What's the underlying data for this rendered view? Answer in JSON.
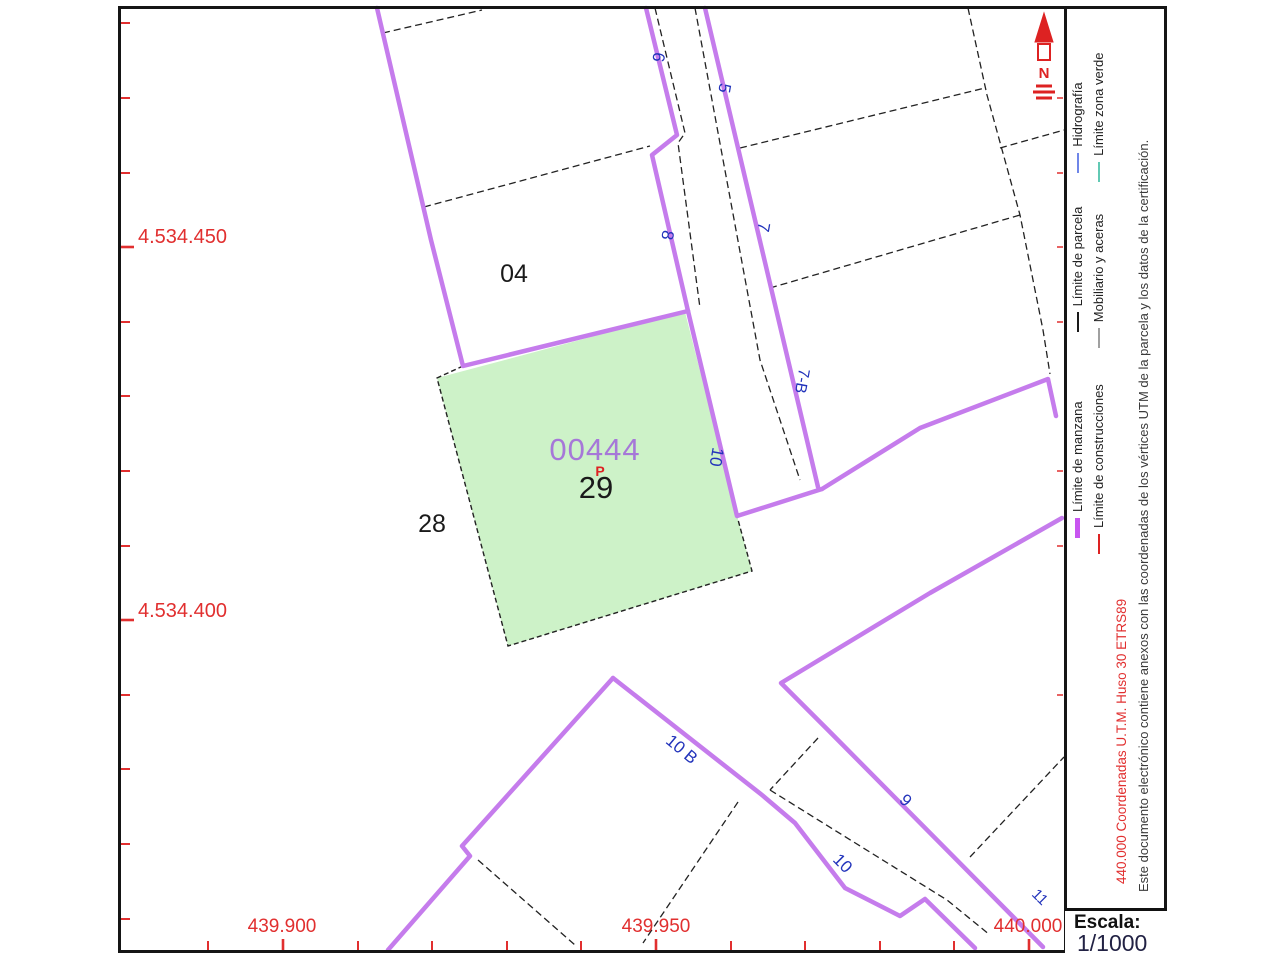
{
  "map": {
    "block_labels": {
      "b04": "04",
      "b28": "28",
      "b29": "29",
      "manzana_code": "00444",
      "flag": "P"
    },
    "street_numbers": {
      "n6": "6",
      "n5": "5",
      "n8": "8",
      "n7": "7",
      "n7b": "7-B",
      "n10_street": "10",
      "n10b": "10 B",
      "n9": "9",
      "n10_strip": "10",
      "n11": "11"
    },
    "coords": {
      "left_top": "4.534.450",
      "left_bottom": "4.534.400",
      "bottom_left": "439.900",
      "bottom_mid": "439.950",
      "bottom_right": "440.000"
    },
    "north_letter": "N"
  },
  "legend": {
    "row1": [
      {
        "label": "Límite de manzana",
        "color": "#c855f0"
      },
      {
        "label": "Límite de parcela",
        "color": "#1a1a1a"
      },
      {
        "label": "Hidrografía",
        "color": "#6f86e8"
      }
    ],
    "row2": [
      {
        "label": "Límite de construcciones",
        "color": "#dd2222"
      },
      {
        "label": "Mobiliario y aceras",
        "color": "#a0a0a0"
      },
      {
        "label": "Límite zona verde",
        "color": "#62c9b4"
      }
    ],
    "coord_note": "440.000 Coordenadas U.T.M. Huso 30 ETRS89",
    "disclaimer": "Este documento electrónico contiene anexos con las coordenadas de los vértices UTM de la parcela y los datos de la certificación."
  },
  "scale": {
    "label": "Escala:",
    "value": "1/1000"
  },
  "colors": {
    "manzana_line": "#c57cec",
    "parcela_line": "#1a1a1a",
    "green_fill": "#cdf2c8",
    "street_label_blue": "#2233bb",
    "coord_red": "#e12f2f",
    "manzana_code_purple": "#a678d8",
    "north_red": "#dd2222"
  }
}
